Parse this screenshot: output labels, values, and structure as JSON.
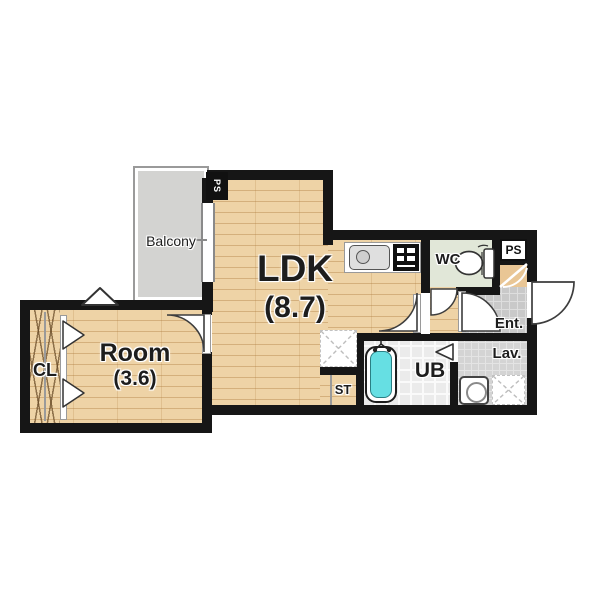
{
  "plan": {
    "type": "apartment-floor-plan",
    "rooms": {
      "balcony": {
        "label": "Balcony"
      },
      "ldk": {
        "label": "LDK",
        "area": "(8.7)"
      },
      "room": {
        "label": "Room",
        "area": "(3.6)"
      },
      "closet": {
        "label": "CL"
      },
      "wc": {
        "label": "WC"
      },
      "ps_top": {
        "label": "PS"
      },
      "ps_corner": {
        "label": "PS"
      },
      "entrance": {
        "label": "Ent."
      },
      "lavatory": {
        "label": "Lav."
      },
      "unit_bath": {
        "label": "UB"
      },
      "storage": {
        "label": "ST"
      }
    },
    "fixtures": [
      "kitchen-sink",
      "gas-stove",
      "toilet",
      "bathtub",
      "washing-machine"
    ],
    "colors": {
      "wall": "#161616",
      "wood_floor": "#eed3a6",
      "balcony_floor": "#d3d3d1",
      "wc_floor": "#e1e7d8",
      "entrance_tile": "#c9c9c9",
      "lavatory_tile": "#d4d4d4",
      "bath_floor": "#ebebeb",
      "bathtub": "#66dfe3",
      "shaft": "#e9c695"
    }
  }
}
